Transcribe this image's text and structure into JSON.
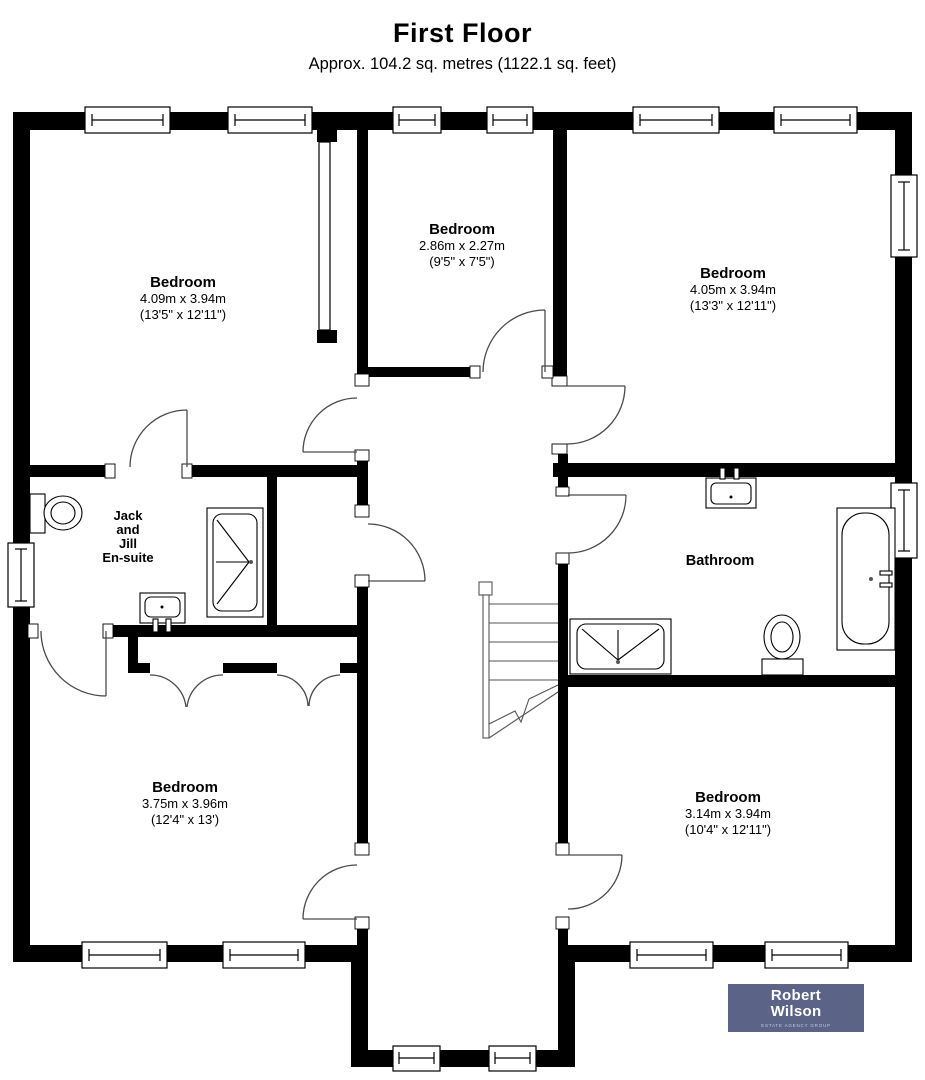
{
  "header": {
    "title": "First Floor",
    "subtitle": "Approx. 104.2 sq. metres (1122.1 sq. feet)"
  },
  "rooms": {
    "bedroom_top_left": {
      "name": "Bedroom",
      "dims_metric": "4.09m x 3.94m",
      "dims_imperial": "(13'5\" x 12'11\")"
    },
    "bedroom_middle": {
      "name": "Bedroom",
      "dims_metric": "2.86m x 2.27m",
      "dims_imperial": "(9'5\" x 7'5\")"
    },
    "bedroom_top_right": {
      "name": "Bedroom",
      "dims_metric": "4.05m x 3.94m",
      "dims_imperial": "(13'3\" x 12'11\")"
    },
    "ensuite": {
      "line1": "Jack",
      "line2": "and",
      "line3": "Jill",
      "line4": "En-suite"
    },
    "bathroom": {
      "name": "Bathroom"
    },
    "bedroom_bottom_left": {
      "name": "Bedroom",
      "dims_metric": "3.75m x 3.96m",
      "dims_imperial": "(12'4\" x 13')"
    },
    "bedroom_bottom_right": {
      "name": "Bedroom",
      "dims_metric": "3.14m x 3.94m",
      "dims_imperial": "(10'4\" x 12'11\")"
    }
  },
  "logo": {
    "name_line1": "Robert",
    "name_line2": "Wilson",
    "tagline": "ESTATE AGENCY GROUP",
    "bg_color": "#5b6387",
    "text_color": "#ffffff"
  },
  "colors": {
    "wall": "#000000",
    "door_line": "#4a4a4a",
    "background": "#ffffff"
  }
}
